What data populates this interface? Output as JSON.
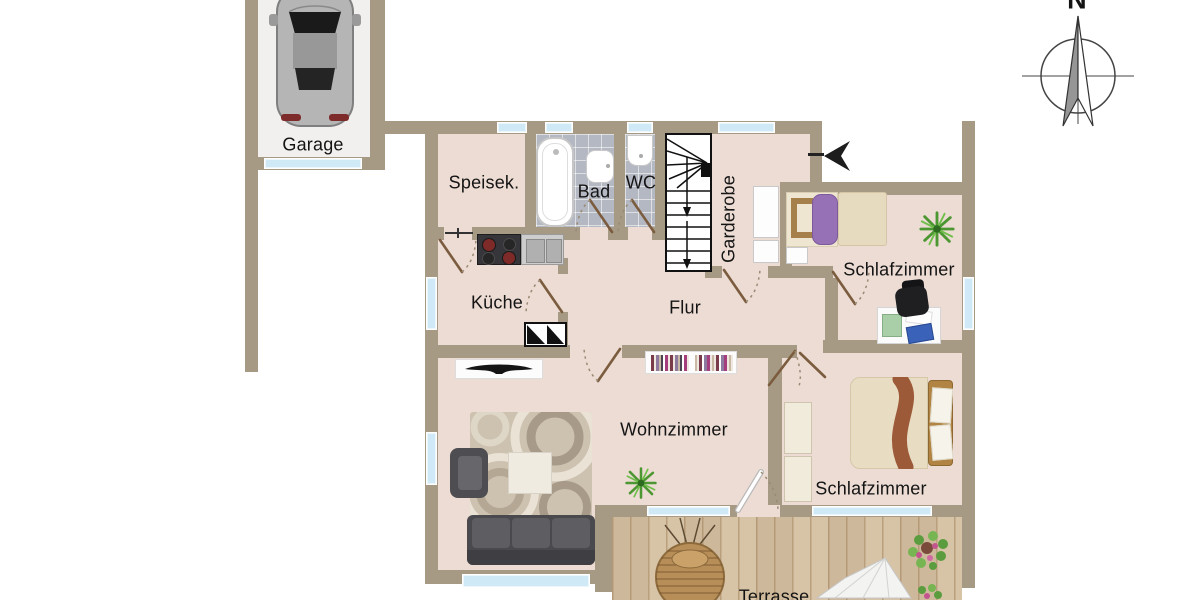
{
  "compass": {
    "north": "N"
  },
  "rooms": {
    "garage": "Garage",
    "speisekammer": "Speisek.",
    "bad": "Bad",
    "wc": "WC",
    "garderobe": "Garderobe",
    "schlafzimmer_nord": "Schlafzimmer",
    "kueche": "Küche",
    "flur": "Flur",
    "wohnzimmer": "Wohnzimmer",
    "schlafzimmer_sued": "Schlafzimmer",
    "terrasse": "Terrasse"
  },
  "colors": {
    "wall": "#a69a84",
    "floor": "#ecdcd4",
    "bath_tile": "#b4b8c2",
    "window_glass": "#cfe9f6",
    "terrace_wood": "#d7c3a6",
    "garage_floor": "#f2f0ee",
    "bed_purple": "#9771b5",
    "bed_throw_brown": "#9c5a38",
    "sofa_gray": "#4a4a4e",
    "plant_green": "#4d9733"
  }
}
